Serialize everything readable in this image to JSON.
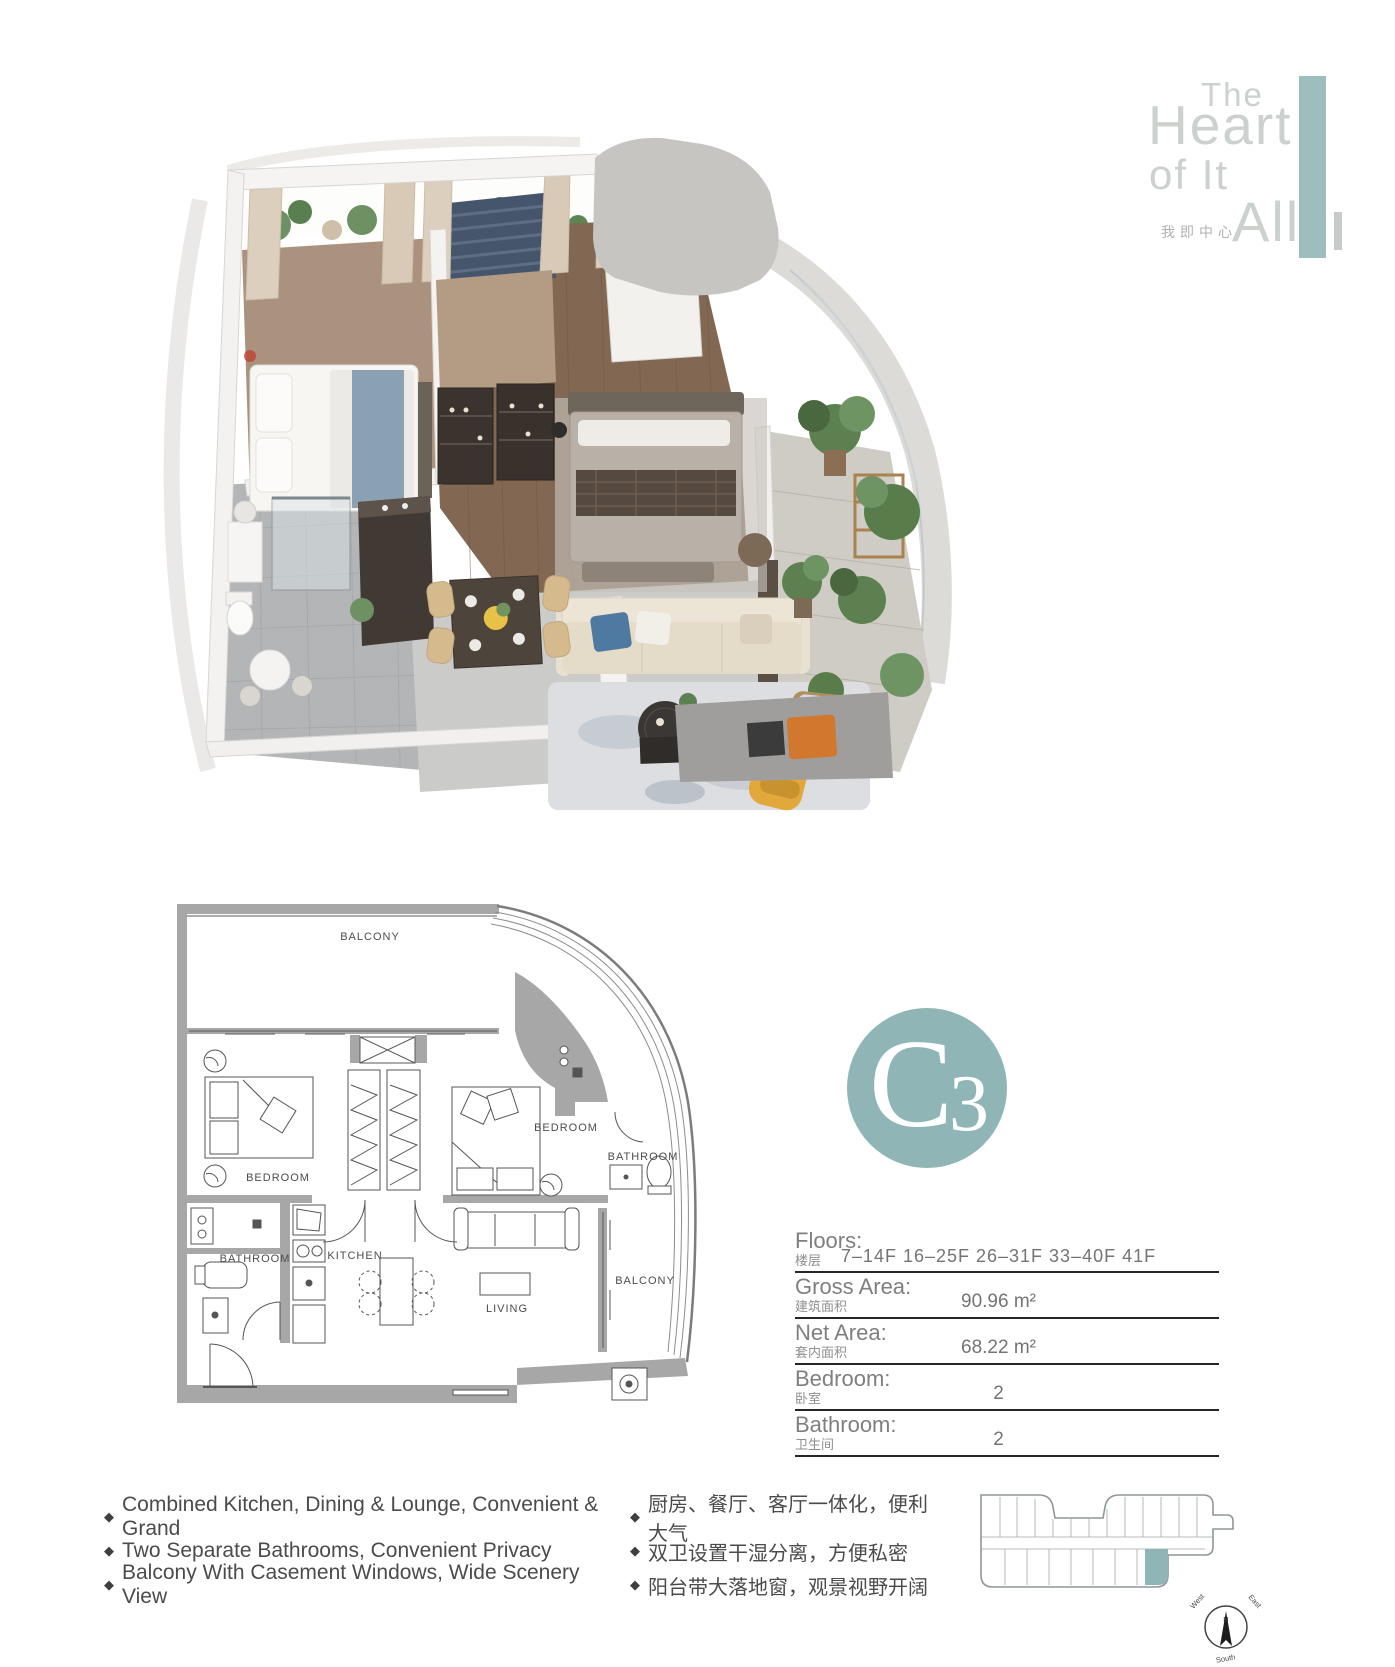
{
  "logo": {
    "line1": "The",
    "line2": "Heart",
    "line3": "of It",
    "line4": "All",
    "tagline": "我即中心"
  },
  "unit": {
    "letter": "C",
    "number": "3"
  },
  "details": {
    "rows": [
      {
        "label": "Floors:",
        "sublabel": "楼层",
        "value": "7–14F  16–25F  26–31F  33–40F  41F"
      },
      {
        "label": "Gross Area:",
        "sublabel": "建筑面积",
        "value": "90.96 m²"
      },
      {
        "label": "Net Area:",
        "sublabel": "套内面积",
        "value": "68.22 m²"
      },
      {
        "label": "Bedroom:",
        "sublabel": "卧室",
        "value": "2"
      },
      {
        "label": "Bathroom:",
        "sublabel": "卫生间",
        "value": "2"
      }
    ]
  },
  "features": {
    "bullet": "◆",
    "en": [
      "Combined Kitchen, Dining & Lounge, Convenient & Grand",
      "Two Separate Bathrooms, Convenient Privacy",
      "Balcony With Casement Windows, Wide Scenery View"
    ],
    "zh": [
      "厨房、餐厅、客厅一体化，便利大气",
      "双卫设置干湿分离，方便私密",
      "阳台带大落地窗，观景视野开阔"
    ]
  },
  "floorplan": {
    "balcony_top": "BALCONY",
    "bedroom_left": "BEDROOM",
    "bedroom_right": "BEDROOM",
    "bathroom_right": "BATHROOM",
    "bathroom_left": "BATHROOM",
    "kitchen": "KITCHEN",
    "living": "LIVING",
    "balcony_right": "BALCONY"
  },
  "compass": {
    "north": "N",
    "west": "West",
    "east": "East",
    "south": "South"
  },
  "colors": {
    "accent_teal": "#8fb5b6",
    "logo_bar_teal": "#9dbebe",
    "wall_gray": "#a7a7a7",
    "line_dark": "#262626",
    "text_gray": "#7f7f7f",
    "text_dark": "#4b4b4b"
  }
}
